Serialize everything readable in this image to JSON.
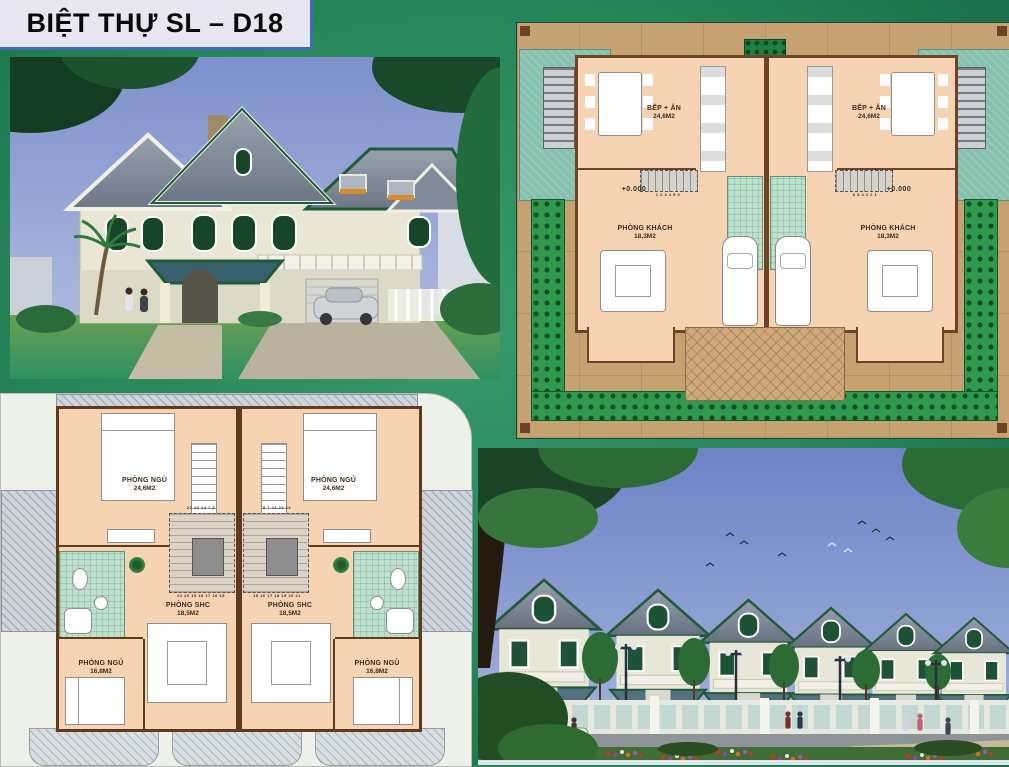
{
  "page": {
    "title": "BIỆT THỰ SL – D18",
    "background_color": "#258457"
  },
  "ground_floor_plan": {
    "caption": "ground floor site plan of twin villa",
    "units": [
      {
        "kitchen_name": "BẾP + ĂN",
        "kitchen_area": "24,6M2",
        "stair_numbers": "1 2 3 4 5 6",
        "level": "+0.000",
        "living_name": "PHÒNG KHÁCH",
        "living_area": "18,3M2"
      },
      {
        "kitchen_name": "BẾP + ĂN",
        "kitchen_area": "24,6M2",
        "stair_numbers": "6 5 4 3 2 1",
        "level": "+0.000",
        "living_name": "PHÒNG KHÁCH",
        "living_area": "18,3M2"
      }
    ]
  },
  "upper_floor_plan": {
    "caption": "upper floor plan of twin villa",
    "units": [
      {
        "bedroom_main_name": "PHÒNG NGỦ",
        "bedroom_main_area": "24,6M2",
        "family_room_name": "PHÒNG SHC",
        "family_room_area": "18,5M2",
        "bedroom_second_name": "PHÒNG NGỦ",
        "bedroom_second_area": "16,8M2",
        "stair_numbers_top": "22 23 24   7 8",
        "stair_numbers_bottom": "21 20 19 18 17 16 15"
      },
      {
        "bedroom_main_name": "PHÒNG NGỦ",
        "bedroom_main_area": "24,6M2",
        "family_room_name": "PHÒNG SHC",
        "family_room_area": "18,5M2",
        "bedroom_second_name": "PHÒNG NGỦ",
        "bedroom_second_area": "16,8M2",
        "stair_numbers_top": "8 7   24 23 22",
        "stair_numbers_bottom": "15 16 17 18 19 20 21"
      }
    ]
  },
  "colors": {
    "paving_tan": "#C6A171",
    "room_peach": "#F5D3B3",
    "hedge_green": "#1B8040",
    "teal_lawn": "#86C0AE",
    "bathroom_mint": "#BFE0CF",
    "sky_blue": "#8092CB",
    "roof_gray": "#78818F",
    "trim_green": "#1E5C38"
  }
}
